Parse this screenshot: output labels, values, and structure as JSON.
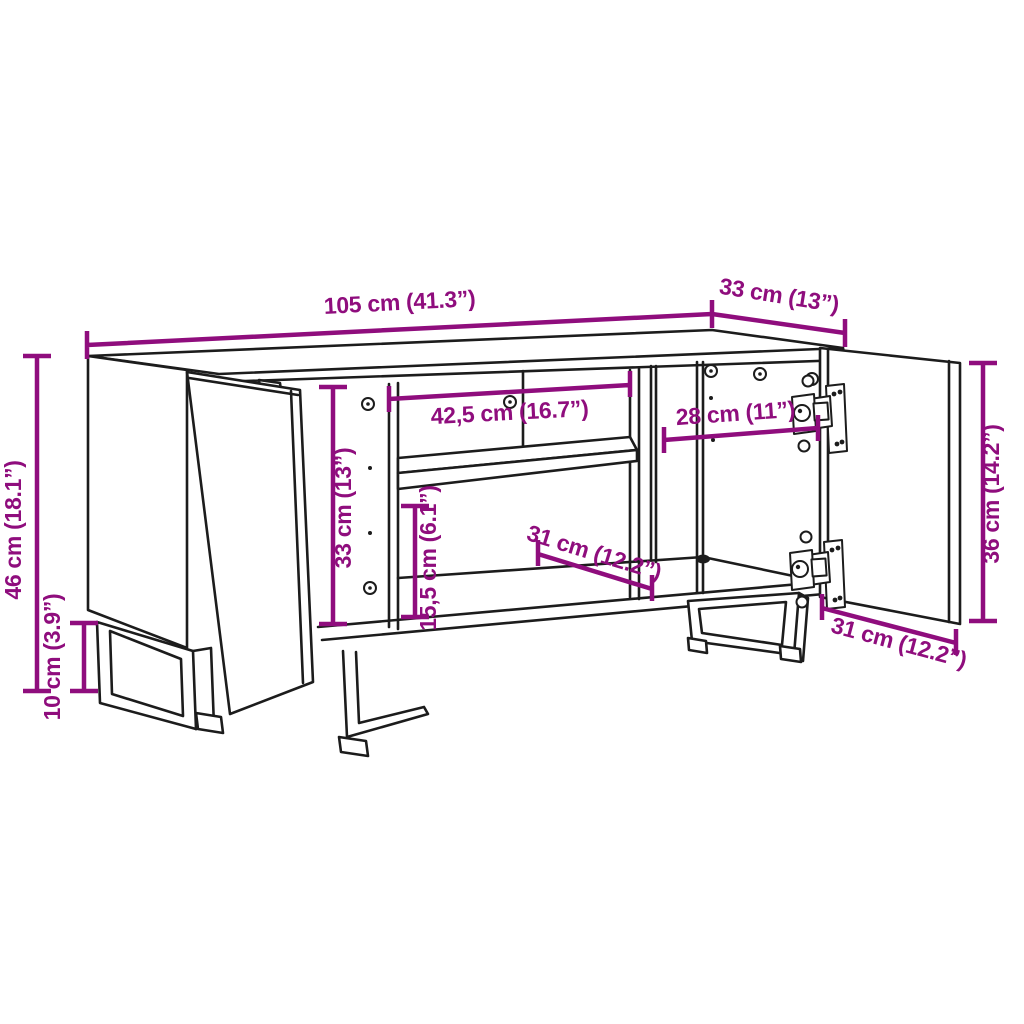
{
  "accent": "#8F0D7D",
  "ink": "#1c1c1c",
  "background": "#ffffff",
  "diagram_type": "furniture-dimension-drawing",
  "subject": "tv-cabinet-with-open-door-and-shelves",
  "dims": {
    "width": "105 cm (41.3”)",
    "depth": "33 cm (13”)",
    "height": "46 cm (18.1”)",
    "leg_height": "10 cm (3.9”)",
    "shelf_width": "42,5 cm (16.7”)",
    "interior_height": "33 cm (13”)",
    "lower_height": "15,5 cm (6.1”)",
    "shelf_depth": "31 cm (12.2”)",
    "right_width": "28 cm (11”)",
    "door_height": "36 cm (14.2”)",
    "door_width": "31 cm (12.2”)"
  }
}
